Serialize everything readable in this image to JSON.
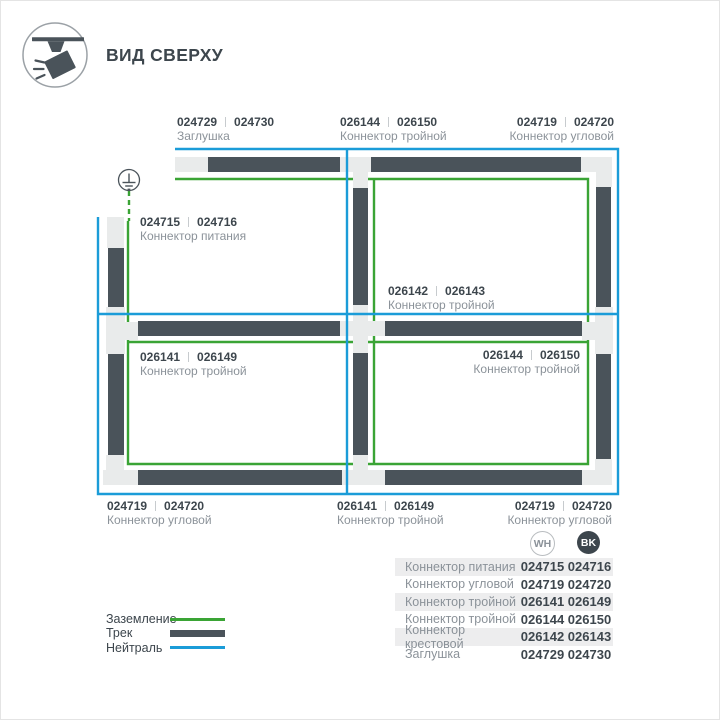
{
  "colors": {
    "track": "#4a535a",
    "connector": "#e9ebeb",
    "ground_green": "#3aa435",
    "neutral_blue": "#1b9cd8",
    "text_dark": "#3d464d",
    "text_gray": "#8b9299",
    "row_bg": "#ededee"
  },
  "header": {
    "title": "ВИД СВЕРХУ",
    "icon": "track-light-icon"
  },
  "diagram": {
    "ground_icon": "earth-ground-icon",
    "labels": [
      {
        "id": "endcap-top",
        "wh": "024729",
        "bk": "024730",
        "name": "Заглушка"
      },
      {
        "id": "t-top",
        "wh": "026144",
        "bk": "026150",
        "name": "Коннектор тройной"
      },
      {
        "id": "corner-top-right",
        "wh": "024719",
        "bk": "024720",
        "name": "Коннектор угловой"
      },
      {
        "id": "power",
        "wh": "024715",
        "bk": "024716",
        "name": "Коннектор питания"
      },
      {
        "id": "cross-center",
        "wh": "026142",
        "bk": "026143",
        "name": "Коннектор тройной"
      },
      {
        "id": "t-left",
        "wh": "026141",
        "bk": "026149",
        "name": "Коннектор тройной"
      },
      {
        "id": "t-right",
        "wh": "026144",
        "bk": "026150",
        "name": "Коннектор тройной"
      },
      {
        "id": "corner-bottom-left",
        "wh": "024719",
        "bk": "024720",
        "name": "Коннектор угловой"
      },
      {
        "id": "t-bottom",
        "wh": "026141",
        "bk": "026149",
        "name": "Коннектор тройной"
      },
      {
        "id": "corner-bottom-right",
        "wh": "024719",
        "bk": "024720",
        "name": "Коннектор угловой"
      }
    ]
  },
  "legend": {
    "items": [
      {
        "label": "Заземление",
        "swatch": "green-line"
      },
      {
        "label": "Трек",
        "swatch": "track-bar"
      },
      {
        "label": "Нейтраль",
        "swatch": "blue-line"
      }
    ]
  },
  "table": {
    "columns": [
      {
        "code": "WH"
      },
      {
        "code": "BK"
      }
    ],
    "rows": [
      {
        "name": "Коннектор питания",
        "wh": "024715",
        "bk": "024716"
      },
      {
        "name": "Коннектор угловой",
        "wh": "024719",
        "bk": "024720"
      },
      {
        "name": "Коннектор тройной",
        "wh": "026141",
        "bk": "026149"
      },
      {
        "name": "Коннектор тройной",
        "wh": "026144",
        "bk": "026150"
      },
      {
        "name": "Коннектор крестовой",
        "wh": "026142",
        "bk": "026143"
      },
      {
        "name": "Заглушка",
        "wh": "024729",
        "bk": "024730"
      }
    ]
  }
}
